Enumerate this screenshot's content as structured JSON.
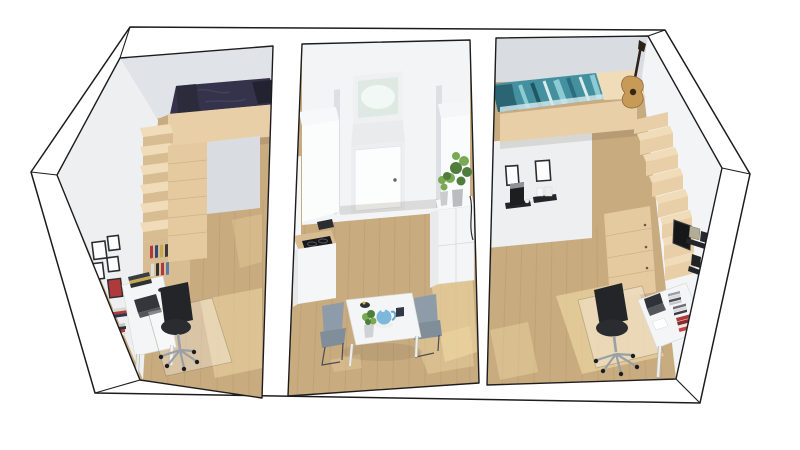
{
  "meta": {
    "title": "Apartment 3D Floor Plan - Cutaway Render",
    "description": "Photorealistic 3D cutaway floor plan viewed from above-front: two mirrored loft bedrooms with desks flank a central kitchen and dining room with entry door.",
    "view": "3d cutaway axonometric",
    "background": "#ffffff"
  },
  "palette": {
    "background": "#ffffff",
    "outline": "#1c1c1e",
    "wall_cut": "#ffffff",
    "wall_light": "#f3f4f6",
    "wall_mid": "#edeff1",
    "wall_shadow": "#e0e3e7",
    "wall_dark": "#d9dce0",
    "wood": "#c9ab80",
    "wood_dark": "#a98b62",
    "wood_sun": "#f2dca6",
    "loft": "#e9cfa7",
    "loft_shadow": "#d9bd92",
    "loft_light": "#f0dcb8",
    "drawer_wood": "#e5c99f",
    "navy": "#35334b",
    "navy_dark": "#232231",
    "teal": "#44909e",
    "teal_dark": "#2a6d7c",
    "teal_light": "#8ccbd4",
    "teal_pale": "#d8edee",
    "white_furniture": "#f4f5f6",
    "furniture_shadow": "#e7e9eb",
    "black": "#232528",
    "metal": "#9aa0a6",
    "gray_chair": "#8d9ca8",
    "green": "#4f7d3c",
    "green_light": "#7aa953",
    "teapot_blue": "#7db7dc",
    "red_accent": "#b03a3a",
    "glass_glow": "#dfe9e3"
  },
  "scene": {
    "type": "apartment-floorplan-cutaway",
    "rooms": [
      {
        "id": "bedroom-left",
        "name": "Left bedroom",
        "objects": [
          "loft bed with dark navy duvet and pillow",
          "stepped shelf staircase to loft",
          "wood drawer cabinet under loft",
          "white desk with books and laptop",
          "black office swivel chair on floor mat",
          "six framed wall pictures, one red",
          "book stacks on floor",
          "oak floor with sunlight patch"
        ]
      },
      {
        "id": "kitchen-dining",
        "name": "Central kitchen and dining room",
        "objects": [
          "white entry door with lit transom window",
          "kitchenette column and counter with black cooktop",
          "white sideboard with two potted plants",
          "tall white cabinet",
          "white dining table",
          "two grey dining chairs",
          "blue teapot, dark mug, bowl and small plant on table",
          "oak floor with sunlight patches"
        ]
      },
      {
        "id": "bedroom-right",
        "name": "Right bedroom",
        "objects": [
          "loft bed with teal striped duvet",
          "acoustic guitar standing on loft platform",
          "stepped shelf staircase with drawer unit",
          "two framed pictures",
          "black wall shelves with espresso machine and cups",
          "wall-mounted monitor and speaker shelves",
          "white desk with laptop, CD stacks and red books",
          "black office swivel chair on floor mat",
          "oak floor with sunlight patches"
        ]
      }
    ]
  }
}
